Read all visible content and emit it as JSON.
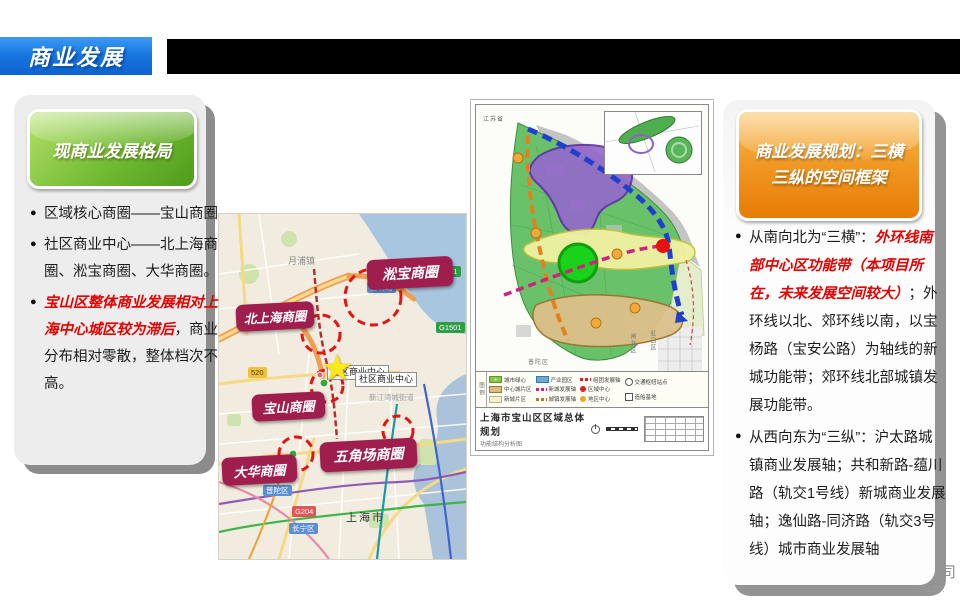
{
  "title_bar": {
    "title": "商业发展"
  },
  "colors": {
    "title_blue": "#1878e0",
    "header_green": "#72bb33",
    "header_orange": "#f09520",
    "label_maroon": "#a01e4e",
    "emphasis_red": "#e60000"
  },
  "left_card": {
    "header": "现商业发展格局",
    "bullets": [
      {
        "segments": [
          {
            "text": "区域核心商圈——宝山商圈",
            "em": false
          }
        ]
      },
      {
        "segments": [
          {
            "text": "社区商业中心——北上海商圈、淞宝商圈、大华商圈。",
            "em": false
          }
        ]
      },
      {
        "segments": [
          {
            "text": "宝山区整体商业发展相对上海中心城区较为滞后",
            "em": true
          },
          {
            "text": "，商业分布相对零散，整体档次不高。",
            "em": false
          }
        ]
      }
    ]
  },
  "right_card": {
    "header": "商业发展规划：三横三纵的空间框架",
    "bullets": [
      {
        "segments": [
          {
            "text": "从南向北为“三横”：",
            "em": false
          },
          {
            "text": "外环线南部中心区功能带（本项目所在，未来发展空间较大）",
            "em": true
          },
          {
            "text": "；外环线以北、郊环线以南，以宝杨路（宝安公路）为轴线的新城功能带；郊环线北部城镇发展功能带。",
            "em": false
          }
        ]
      },
      {
        "segments": [
          {
            "text": "从西向东为“三纵”：沪太路城镇商业发展轴；共和新路-蕴川路（轨交1号线）新城商业发展轴；逸仙路-同济路（轨交3号线）城市商业发展轴",
            "em": false
          }
        ]
      }
    ]
  },
  "street_map": {
    "labels": [
      {
        "text": "淞宝商圈"
      },
      {
        "text": "北上海商圈"
      },
      {
        "text": "宝山商圈"
      },
      {
        "text": "大华商圈"
      },
      {
        "text": "五角场商圈"
      }
    ],
    "poi_boxes": [
      {
        "text": "社区商业中心"
      },
      {
        "text": "社区商业中心"
      }
    ],
    "map_texts": {
      "yuepu": "月浦镇",
      "xinjiangwan": "新江湾城街道",
      "shanghai": "上海市",
      "putuo": "普陀区",
      "changning": "长宁区"
    },
    "road_badges": {
      "g1501a": "G1501",
      "g1501b": "G1501",
      "baoyang": "宝杨路",
      "s520": "520",
      "g204": "G204"
    },
    "star_glyph": "★"
  },
  "planning_map": {
    "title": "上海市宝山区区域总体规划",
    "subtitle": "功能结构分析图",
    "corner_label": "江苏省",
    "neighbor_labels": {
      "putuo": "普陀区",
      "zhabei": "闸北区",
      "hongkou": "虹口区"
    },
    "legend_title": "图例",
    "legend": [
      {
        "label": "城市绿心"
      },
      {
        "label": "中心城片区"
      },
      {
        "label": "新城片区"
      },
      {
        "label": "产业园区"
      },
      {
        "label": "新城发展轴"
      },
      {
        "label": "城镇发展轴"
      },
      {
        "label": "组团发展轴"
      },
      {
        "label": "区域中心"
      },
      {
        "label": "地区中心"
      },
      {
        "label": "交通枢纽站点"
      },
      {
        "label": "造船基地"
      }
    ]
  },
  "watermark": {
    "char": "司",
    "ltd": "...LTD."
  }
}
